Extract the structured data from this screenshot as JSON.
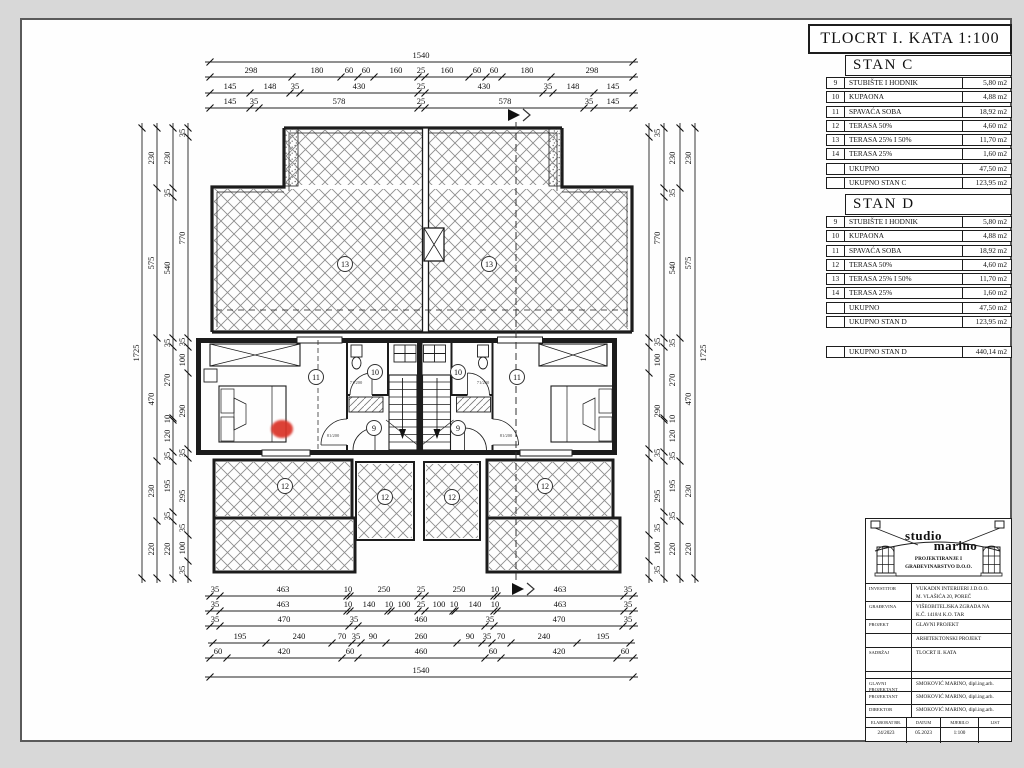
{
  "title": "TLOCRT I. KATA 1:100",
  "apartments": [
    {
      "name": "STAN C",
      "rows": [
        [
          "9",
          "STUBIŠTE I HODNIK",
          "5,80 m2"
        ],
        [
          "10",
          "KUPAONA",
          "4,88 m2"
        ],
        [
          "11",
          "SPAVAĆA SOBA",
          "18,92 m2"
        ],
        [
          "12",
          "TERASA 50%",
          "4,60 m2"
        ],
        [
          "13",
          "TERASA 25% I 50%",
          "11,70 m2"
        ],
        [
          "14",
          "TERASA 25%",
          "1,60 m2"
        ],
        [
          "",
          "UKUPNO",
          "47,50 m2"
        ],
        [
          "",
          "UKUPNO STAN C",
          "123,95 m2"
        ]
      ]
    },
    {
      "name": "STAN D",
      "rows": [
        [
          "9",
          "STUBIŠTE I HODNIK",
          "5,80 m2"
        ],
        [
          "10",
          "KUPAONA",
          "4,88 m2"
        ],
        [
          "11",
          "SPAVAĆA SOBA",
          "18,92 m2"
        ],
        [
          "12",
          "TERASA 50%",
          "4,60 m2"
        ],
        [
          "13",
          "TERASA 25% I 50%",
          "11,70 m2"
        ],
        [
          "14",
          "TERASA 25%",
          "1,60 m2"
        ],
        [
          "",
          "UKUPNO",
          "47,50 m2"
        ],
        [
          "",
          "UKUPNO STAN D",
          "123,95 m2"
        ]
      ]
    }
  ],
  "building_total_row": [
    "",
    "UKUPNO STAN D",
    "440,14 m2"
  ],
  "titleblock": {
    "studio_top": "studio",
    "studio_bottom": "marino",
    "subtitle_line1": "PROJEKTIRANJE I",
    "subtitle_line2": "GRAĐEVINARSTVO D.O.O.",
    "rows": [
      {
        "label": "INVESTITOR",
        "lines": [
          "VUKADIN INTERIJERI J.D.O.O.",
          "M. VLAŠIĆA 20, POREČ"
        ],
        "h": 18
      },
      {
        "label": "GRAĐEVINA",
        "lines": [
          "VIŠEOBITELJSKA ZGRADA NA",
          "K.Č. 1418/4 K.O. TAR"
        ],
        "h": 18
      },
      {
        "label": "PROJEKT",
        "lines": [
          "GLAVNI PROJEKT"
        ],
        "h": 14
      },
      {
        "label": "",
        "lines": [
          "ARHITEKTONSKI PROJEKT"
        ],
        "h": 14
      },
      {
        "label": "SADRŽAJ",
        "lines": [
          "TLOCRT II. KATA"
        ],
        "h": 24
      },
      {
        "label": "",
        "lines": [
          ""
        ],
        "h": 7
      },
      {
        "label": "GLAVNI PROJEKTANT",
        "lines": [
          "SMOKOVIĆ MARINO, dipl.ing.arh."
        ],
        "h": 13
      },
      {
        "label": "PROJEKTANT",
        "lines": [
          "SMOKOVIĆ MARINO, dipl.ing.arh."
        ],
        "h": 13
      },
      {
        "label": "DIREKTOR",
        "lines": [
          "SMOKOVIĆ MARINO, dipl.ing.arh."
        ],
        "h": 13
      }
    ],
    "footer": [
      {
        "label": "ELABORAT BR.",
        "value": "24/2023",
        "w": 41
      },
      {
        "label": "DATUM",
        "value": "05.2023",
        "w": 34
      },
      {
        "label": "MJERILO",
        "value": "1:100",
        "w": 38
      },
      {
        "label": "LIST",
        "value": "",
        "w": 32
      }
    ]
  },
  "colors": {
    "page_bg": "#d8d8d8",
    "sheet": "#fefefe",
    "line": "#1c1c1c",
    "marker_red": "#da3328"
  },
  "plan": {
    "room_labels": [
      {
        "n": "13",
        "x": 345,
        "y": 264
      },
      {
        "n": "13",
        "x": 489,
        "y": 264
      },
      {
        "n": "11",
        "x": 316,
        "y": 377
      },
      {
        "n": "10",
        "x": 375,
        "y": 372
      },
      {
        "n": "9",
        "x": 374,
        "y": 428
      },
      {
        "n": "10",
        "x": 458,
        "y": 372
      },
      {
        "n": "9",
        "x": 458,
        "y": 428
      },
      {
        "n": "11",
        "x": 517,
        "y": 377
      },
      {
        "n": "12",
        "x": 285,
        "y": 486
      },
      {
        "n": "12",
        "x": 385,
        "y": 497
      },
      {
        "n": "12",
        "x": 452,
        "y": 497
      },
      {
        "n": "12",
        "x": 545,
        "y": 486
      }
    ],
    "door_labels": [
      {
        "t": "71/200",
        "x": 356,
        "y": 384
      },
      {
        "t": "81/200",
        "x": 333,
        "y": 437
      },
      {
        "t": "71/200",
        "x": 483,
        "y": 384
      },
      {
        "t": "81/200",
        "x": 506,
        "y": 437
      }
    ],
    "h_chains": [
      {
        "y": 62,
        "x0": 210,
        "x1": 633,
        "ly": 58,
        "ticks": [
          210,
          633
        ],
        "labels": [
          [
            "1540",
            421
          ]
        ]
      },
      {
        "y": 77,
        "x0": 210,
        "x1": 633,
        "ly": 73,
        "ticks": [
          210,
          292,
          341,
          358,
          374,
          418,
          425,
          469,
          486,
          502,
          551,
          633
        ],
        "labels": [
          [
            "298",
            251
          ],
          [
            "180",
            317
          ],
          [
            "60",
            349
          ],
          [
            "60",
            366
          ],
          [
            "160",
            396
          ],
          [
            "25",
            421
          ],
          [
            "160",
            447
          ],
          [
            "60",
            477
          ],
          [
            "60",
            494
          ],
          [
            "180",
            527
          ],
          [
            "298",
            592
          ]
        ]
      },
      {
        "y": 93,
        "x0": 210,
        "x1": 633,
        "ly": 89,
        "ticks": [
          210,
          250,
          290,
          300,
          418,
          425,
          543,
          553,
          594,
          633
        ],
        "labels": [
          [
            "145",
            230
          ],
          [
            "148",
            270
          ],
          [
            "35",
            295
          ],
          [
            "430",
            359
          ],
          [
            "25",
            421
          ],
          [
            "430",
            484
          ],
          [
            "35",
            548
          ],
          [
            "148",
            573
          ],
          [
            "145",
            613
          ]
        ]
      },
      {
        "y": 108,
        "x0": 210,
        "x1": 633,
        "ly": 104,
        "ticks": [
          210,
          250,
          259,
          418,
          425,
          584,
          594,
          633
        ],
        "labels": [
          [
            "145",
            230
          ],
          [
            "35",
            254
          ],
          [
            "578",
            339
          ],
          [
            "25",
            421
          ],
          [
            "578",
            505
          ],
          [
            "35",
            589
          ],
          [
            "145",
            613
          ]
        ]
      },
      {
        "y": 596,
        "x0": 210,
        "x1": 633,
        "ly": 592,
        "ticks": [
          210,
          220,
          347,
          350,
          418,
          425,
          494,
          497,
          624,
          633
        ],
        "labels": [
          [
            "35",
            215
          ],
          [
            "463",
            283
          ],
          [
            "10",
            348
          ],
          [
            "250",
            384
          ],
          [
            "25",
            421
          ],
          [
            "250",
            459
          ],
          [
            "10",
            495
          ],
          [
            "463",
            560
          ],
          [
            "35",
            628
          ]
        ]
      },
      {
        "y": 611,
        "x0": 210,
        "x1": 633,
        "ly": 607,
        "ticks": [
          210,
          220,
          347,
          350,
          388,
          391,
          418,
          425,
          453,
          455,
          494,
          497,
          624,
          633
        ],
        "labels": [
          [
            "35",
            215
          ],
          [
            "463",
            283
          ],
          [
            "10",
            348
          ],
          [
            "140",
            369
          ],
          [
            "10",
            389
          ],
          [
            "100",
            404
          ],
          [
            "25",
            421
          ],
          [
            "100",
            439
          ],
          [
            "10",
            454
          ],
          [
            "140",
            475
          ],
          [
            "10",
            495
          ],
          [
            "463",
            560
          ],
          [
            "35",
            628
          ]
        ]
      },
      {
        "y": 626,
        "x0": 210,
        "x1": 633,
        "ly": 622,
        "ticks": [
          210,
          220,
          349,
          358,
          485,
          494,
          623,
          633
        ],
        "labels": [
          [
            "35",
            215
          ],
          [
            "470",
            284
          ],
          [
            "35",
            354
          ],
          [
            "460",
            421
          ],
          [
            "35",
            490
          ],
          [
            "470",
            559
          ],
          [
            "35",
            628
          ]
        ]
      },
      {
        "y": 643,
        "x0": 213,
        "x1": 630,
        "ly": 639,
        "ticks": [
          213,
          266,
          332,
          352,
          361,
          386,
          457,
          482,
          492,
          511,
          577,
          630
        ],
        "labels": [
          [
            "195",
            240
          ],
          [
            "240",
            299
          ],
          [
            "70",
            342
          ],
          [
            "35",
            356
          ],
          [
            "90",
            373
          ],
          [
            "260",
            421
          ],
          [
            "90",
            470
          ],
          [
            "35",
            487
          ],
          [
            "70",
            501
          ],
          [
            "240",
            544
          ],
          [
            "195",
            603
          ]
        ]
      },
      {
        "y": 658,
        "x0": 210,
        "x1": 633,
        "ly": 654,
        "ticks": [
          210,
          227,
          342,
          358,
          485,
          501,
          617,
          633
        ],
        "labels": [
          [
            "60",
            218
          ],
          [
            "420",
            284
          ],
          [
            "60",
            350
          ],
          [
            "460",
            421
          ],
          [
            "60",
            493
          ],
          [
            "420",
            559
          ],
          [
            "60",
            625
          ]
        ]
      },
      {
        "y": 677,
        "x0": 210,
        "x1": 633,
        "ly": 673,
        "ticks": [
          210,
          633
        ],
        "labels": [
          [
            "1540",
            421
          ]
        ]
      }
    ],
    "v_chains": [
      {
        "x": 142,
        "y0": 128,
        "y1": 578,
        "lx": 139,
        "ticks": [
          128,
          578
        ],
        "labels": [
          [
            "1725",
            353
          ]
        ]
      },
      {
        "x": 157,
        "y0": 128,
        "y1": 578,
        "lx": 154,
        "ticks": [
          128,
          188,
          338,
          461,
          521,
          578
        ],
        "labels": [
          [
            "230",
            158
          ],
          [
            "575",
            263
          ],
          [
            "470",
            399
          ],
          [
            "230",
            491
          ],
          [
            "220",
            549
          ]
        ]
      },
      {
        "x": 173,
        "y0": 128,
        "y1": 578,
        "lx": 170,
        "ticks": [
          128,
          188,
          197,
          338,
          347,
          418,
          420,
          452,
          461,
          512,
          521,
          578
        ],
        "labels": [
          [
            "230",
            158
          ],
          [
            "35",
            193
          ],
          [
            "540",
            268
          ],
          [
            "35",
            343
          ],
          [
            "270",
            380
          ],
          [
            "10",
            419
          ],
          [
            "120",
            436
          ],
          [
            "35",
            456
          ],
          [
            "195",
            486
          ],
          [
            "35",
            516
          ],
          [
            "220",
            549
          ]
        ]
      },
      {
        "x": 188,
        "y0": 128,
        "y1": 578,
        "lx": 185,
        "ticks": [
          128,
          137,
          338,
          347,
          373,
          449,
          458,
          535,
          561,
          578
        ],
        "labels": [
          [
            "35",
            133
          ],
          [
            "770",
            238
          ],
          [
            "35",
            342
          ],
          [
            "100",
            360
          ],
          [
            "290",
            411
          ],
          [
            "35",
            453
          ],
          [
            "295",
            496
          ],
          [
            "35",
            528
          ],
          [
            "100",
            548
          ],
          [
            "35",
            570
          ]
        ]
      },
      {
        "x": 649,
        "y0": 128,
        "y1": 578,
        "lx": 660,
        "ticks": [
          128,
          137,
          338,
          347,
          373,
          449,
          458,
          535,
          561,
          578
        ],
        "labels": [
          [
            "35",
            133
          ],
          [
            "770",
            238
          ],
          [
            "35",
            342
          ],
          [
            "100",
            360
          ],
          [
            "290",
            411
          ],
          [
            "35",
            453
          ],
          [
            "295",
            496
          ],
          [
            "35",
            528
          ],
          [
            "100",
            548
          ],
          [
            "35",
            570
          ]
        ]
      },
      {
        "x": 664,
        "y0": 128,
        "y1": 578,
        "lx": 675,
        "ticks": [
          128,
          188,
          197,
          338,
          347,
          418,
          420,
          452,
          461,
          512,
          521,
          578
        ],
        "labels": [
          [
            "230",
            158
          ],
          [
            "35",
            193
          ],
          [
            "540",
            268
          ],
          [
            "35",
            343
          ],
          [
            "270",
            380
          ],
          [
            "10",
            419
          ],
          [
            "120",
            436
          ],
          [
            "35",
            456
          ],
          [
            "195",
            486
          ],
          [
            "35",
            516
          ],
          [
            "220",
            549
          ]
        ]
      },
      {
        "x": 680,
        "y0": 128,
        "y1": 578,
        "lx": 691,
        "ticks": [
          128,
          188,
          338,
          461,
          521,
          578
        ],
        "labels": [
          [
            "230",
            158
          ],
          [
            "575",
            263
          ],
          [
            "470",
            399
          ],
          [
            "230",
            491
          ],
          [
            "220",
            549
          ]
        ]
      },
      {
        "x": 695,
        "y0": 128,
        "y1": 578,
        "lx": 706,
        "ticks": [
          128,
          578
        ],
        "labels": [
          [
            "1725",
            353
          ]
        ]
      }
    ]
  }
}
